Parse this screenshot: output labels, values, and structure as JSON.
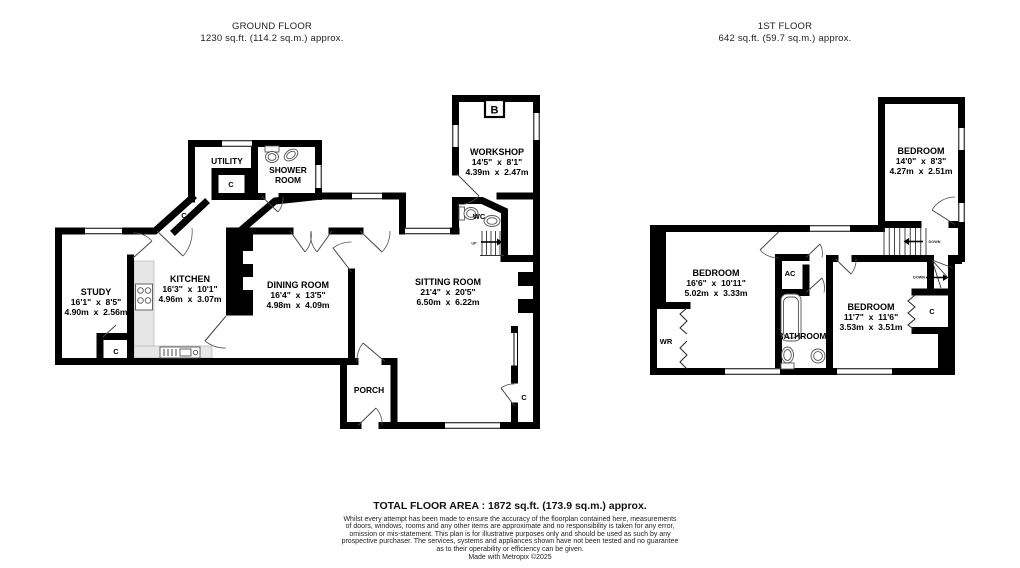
{
  "colors": {
    "wall": "#000000",
    "background": "#ffffff",
    "counter": "#e6e6e6",
    "fixture_outline": "#555555"
  },
  "ground_floor": {
    "title": "GROUND FLOOR",
    "subtitle": "1230 sq.ft. (114.2 sq.m.) approx.",
    "rooms": {
      "study": {
        "name": "STUDY",
        "imperial": "16'1\"  x  8'5\"",
        "metric": "4.90m  x  2.56m"
      },
      "kitchen": {
        "name": "KITCHEN",
        "imperial": "16'3\"  x  10'1\"",
        "metric": "4.96m  x  3.07m"
      },
      "dining_room": {
        "name": "DINING ROOM",
        "imperial": "16'4\"  x  13'5\"",
        "metric": "4.98m  x  4.09m"
      },
      "sitting_room": {
        "name": "SITTING ROOM",
        "imperial": "21'4\"  x  20'5\"",
        "metric": "6.50m  x  6.22m"
      },
      "workshop": {
        "name": "WORKSHOP",
        "imperial": "14'5\"  x  8'1\"",
        "metric": "4.39m  x  2.47m"
      }
    },
    "labels": {
      "utility": "UTILITY",
      "shower_room_line1": "SHOWER",
      "shower_room_line2": "ROOM",
      "porch": "PORCH",
      "wc": "WC",
      "boiler": "B",
      "cupboard": "C",
      "up": "UP"
    }
  },
  "first_floor": {
    "title": "1ST FLOOR",
    "subtitle": "642 sq.ft. (59.7 sq.m.) approx.",
    "rooms": {
      "bedroom_top": {
        "name": "BEDROOM",
        "imperial": "14'0\"  x  8'3\"",
        "metric": "4.27m  x  2.51m"
      },
      "bedroom_left": {
        "name": "BEDROOM",
        "imperial": "16'6\"  x  10'11\"",
        "metric": "5.02m  x  3.33m"
      },
      "bedroom_right": {
        "name": "BEDROOM",
        "imperial": "11'7\"  x  11'6\"",
        "metric": "3.53m  x  3.51m"
      }
    },
    "labels": {
      "bathroom": "BATHROOM",
      "airing_cupboard": "AC",
      "wardrobe": "WR",
      "cupboard": "C",
      "down": "DOWN"
    }
  },
  "footer": {
    "total_area": "TOTAL FLOOR AREA : 1872 sq.ft. (173.9 sq.m.) approx.",
    "disclaimer": "Whilst every attempt has been made to ensure the accuracy of the floorplan contained here, measurements\nof doors, windows, rooms and any other items are approximate and no responsibility is taken for any error,\nomission or mis-statement. This plan is for illustrative purposes only and should be used as such by any\nprospective purchaser. The services, systems and appliances shown have not been tested and no guarantee\nas to their operability or efficiency can be given.",
    "credit": "Made with Metropix ©2025"
  }
}
